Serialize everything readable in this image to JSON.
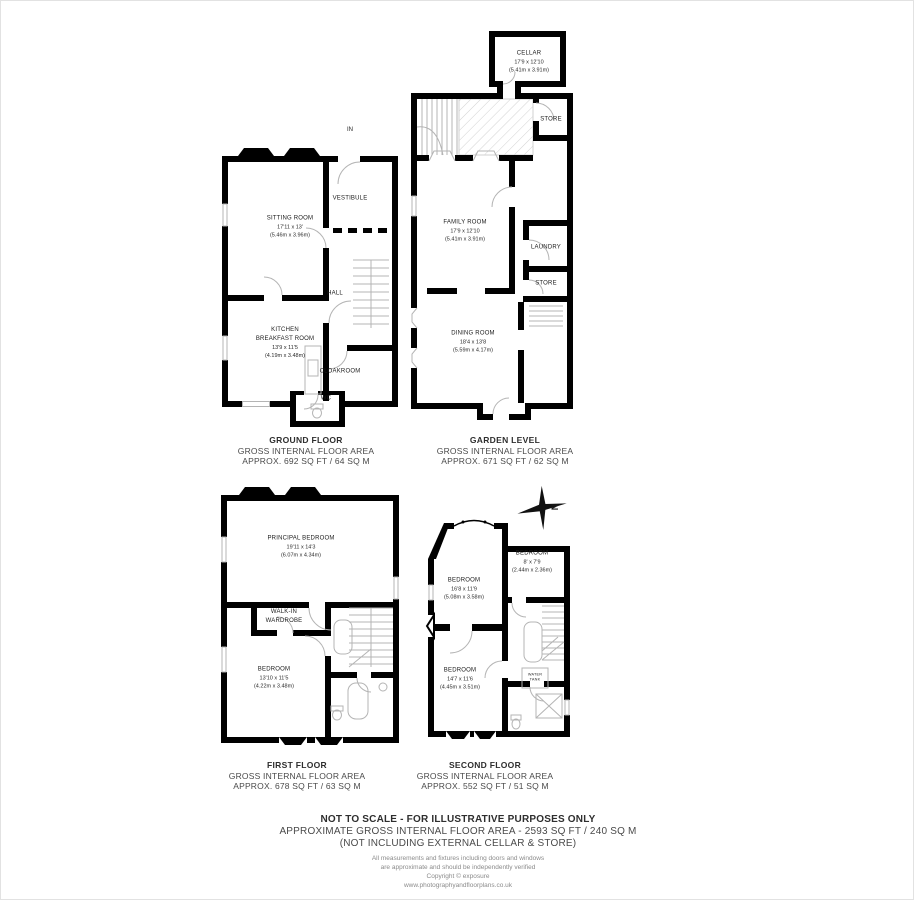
{
  "compass": {
    "north_label": "N"
  },
  "ground": {
    "title": "GROUND FLOOR",
    "area1": "GROSS INTERNAL FLOOR AREA",
    "area2": "APPROX. 692 SQ FT / 64 SQ M",
    "in_label": "IN",
    "sitting": {
      "name": "SITTING ROOM",
      "imp": "17'11 x 13'",
      "met": "(5.46m x 3.96m)"
    },
    "vestibule": {
      "name": "VESTIBULE"
    },
    "hall": {
      "name": "HALL"
    },
    "kitchen": {
      "name": "KITCHEN",
      "name2": "BREAKFAST ROOM",
      "imp": "13'9 x 11'5",
      "met": "(4.19m x 3.48m)"
    },
    "cloakroom": {
      "name": "CLOAKROOM"
    },
    "wc": {
      "name": "WC"
    }
  },
  "garden": {
    "title": "GARDEN LEVEL",
    "area1": "GROSS INTERNAL FLOOR AREA",
    "area2": "APPROX. 671 SQ FT / 62 SQ M",
    "cellar": {
      "name": "CELLAR",
      "imp": "17'9 x 12'10",
      "met": "(5.41m x 3.91m)"
    },
    "store_top": {
      "name": "STORE"
    },
    "family": {
      "name": "FAMILY ROOM",
      "imp": "17'9 x 12'10",
      "met": "(5.41m x 3.91m)"
    },
    "laundry": {
      "name": "LAUNDRY"
    },
    "store": {
      "name": "STORE"
    },
    "dining": {
      "name": "DINING ROOM",
      "imp": "18'4 x 13'8",
      "met": "(5.59m x 4.17m)"
    }
  },
  "first": {
    "title": "FIRST FLOOR",
    "area1": "GROSS INTERNAL FLOOR AREA",
    "area2": "APPROX. 678 SQ FT / 63 SQ M",
    "principal": {
      "name": "PRINCIPAL BEDROOM",
      "imp": "19'11 x 14'3",
      "met": "(6.07m x 4.34m)"
    },
    "walkin": {
      "name": "WALK-IN",
      "name2": "WARDROBE"
    },
    "bedroom": {
      "name": "BEDROOM",
      "imp": "13'10 x 11'5",
      "met": "(4.22m x 3.48m)"
    }
  },
  "second": {
    "title": "SECOND FLOOR",
    "area1": "GROSS INTERNAL FLOOR AREA",
    "area2": "APPROX. 552 SQ FT / 51 SQ M",
    "bedroom1": {
      "name": "BEDROOM",
      "imp": "16'8 x 11'9",
      "met": "(5.08m x 3.58m)"
    },
    "bedroom2": {
      "name": "BEDROOM",
      "imp": "8' x 7'9",
      "met": "(2.44m x 2.36m)"
    },
    "bedroom3": {
      "name": "BEDROOM",
      "imp": "14'7 x 11'6",
      "met": "(4.45m x 3.51m)"
    },
    "watertank": {
      "name": "WATER",
      "name2": "TANK"
    }
  },
  "footer": {
    "line1": "NOT TO SCALE - FOR ILLUSTRATIVE PURPOSES ONLY",
    "line2": "APPROXIMATE GROSS INTERNAL FLOOR AREA - 2593 SQ FT / 240 SQ M",
    "line3": "(NOT INCLUDING EXTERNAL CELLAR & STORE)",
    "line4": "All measurements and fixtures including doors and windows",
    "line5": "are approximate and should be independently verified",
    "line6": "Copyright © exposure",
    "line7": "www.photographyandfloorplans.co.uk"
  }
}
